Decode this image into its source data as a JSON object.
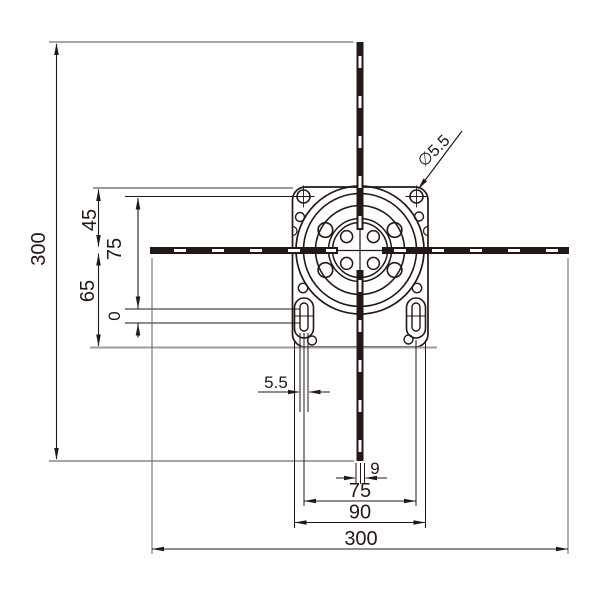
{
  "drawing": {
    "kind": "technical-dimension-drawing",
    "subject": "motor mounting flange, front view with centerlines",
    "colors": {
      "ink": "#231815",
      "gray_line": "#9c9c9c",
      "background": "#ffffff"
    }
  },
  "labels": {
    "height_overall": "300",
    "top_to_center": "45",
    "center_to_bottom": "65",
    "hole_span_vertical": "75",
    "slot_ref": "0",
    "hole_dia_callout": "∅5.5",
    "slot_width": "5.5",
    "shaft_width": "9",
    "slot_pitch": "75",
    "slot_outer_span": "90",
    "width_overall": "300"
  }
}
